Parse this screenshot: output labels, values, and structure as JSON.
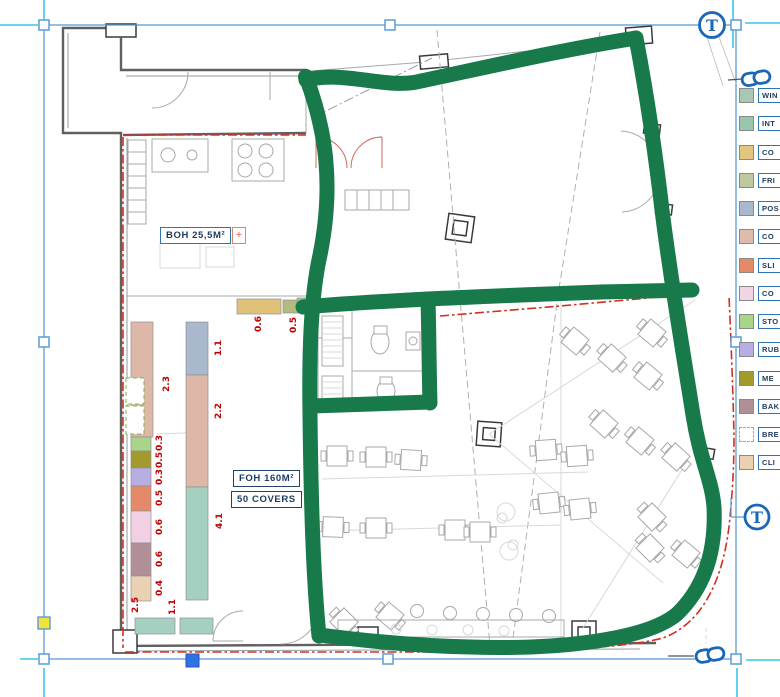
{
  "colors": {
    "green_marker": "#187a4b",
    "selection_blue": "#5b9bd5",
    "guide_cyan": "#3ac6e8",
    "icon_blue": "#1b67b5",
    "handle_yellow": "#f2e23c",
    "handle_blue": "#2f72e8",
    "red_dimension": "#c00000",
    "red_line": "#d03020"
  },
  "icons": {
    "text_tool": "T",
    "top_right_anchor": "text-anchor-icon",
    "right_anchor": "text-anchor-icon",
    "top_link": "link-icon",
    "bottom_link": "link-icon"
  },
  "plan_labels": {
    "boh": "BOH 25,5M²",
    "boh_plus": "+",
    "foh": "FOH 160M²",
    "covers": "50 COVERS"
  },
  "legend": {
    "items": [
      {
        "label": "WIN",
        "color": "#a9c8b4",
        "style": "solid"
      },
      {
        "label": "INT",
        "color": "#99c6ae",
        "style": "solid"
      },
      {
        "label": "CO",
        "color": "#e2c57f",
        "style": "solid"
      },
      {
        "label": "FRI",
        "color": "#bec9a0",
        "style": "solid"
      },
      {
        "label": "POS",
        "color": "#a9b8cc",
        "style": "solid"
      },
      {
        "label": "CO",
        "color": "#dcbcae",
        "style": "solid"
      },
      {
        "label": "SLI",
        "color": "#e58a68",
        "style": "solid"
      },
      {
        "label": "CO",
        "color": "#f2d5e4",
        "style": "solid"
      },
      {
        "label": "STO",
        "color": "#a8d58a",
        "style": "solid"
      },
      {
        "label": "RUB",
        "color": "#b9aee4",
        "style": "solid"
      },
      {
        "label": "ME",
        "color": "#a39a2e",
        "style": "solid"
      },
      {
        "label": "BAK",
        "color": "#b08f96",
        "style": "solid"
      },
      {
        "label": "BRE",
        "color": "#ffffff",
        "style": "dashed"
      },
      {
        "label": "CLI",
        "color": "#ecd0b4",
        "style": "solid"
      }
    ]
  },
  "dimensions": [
    {
      "text": "2.3",
      "x": 167,
      "y": 385
    },
    {
      "text": "1.1",
      "x": 219,
      "y": 349
    },
    {
      "text": "2.2",
      "x": 219,
      "y": 412
    },
    {
      "text": "4.1",
      "x": 220,
      "y": 522
    },
    {
      "text": "0.3",
      "x": 160,
      "y": 444
    },
    {
      "text": "0.5",
      "x": 160,
      "y": 461
    },
    {
      "text": "0.3",
      "x": 160,
      "y": 478
    },
    {
      "text": "0.5",
      "x": 160,
      "y": 499
    },
    {
      "text": "0.6",
      "x": 160,
      "y": 528
    },
    {
      "text": "0.6",
      "x": 160,
      "y": 560
    },
    {
      "text": "0.4",
      "x": 160,
      "y": 589
    },
    {
      "text": "2.5",
      "x": 136,
      "y": 606
    },
    {
      "text": "1.1",
      "x": 173,
      "y": 608
    },
    {
      "text": "0.6",
      "x": 259,
      "y": 325
    },
    {
      "text": "0.5",
      "x": 294,
      "y": 326
    }
  ]
}
